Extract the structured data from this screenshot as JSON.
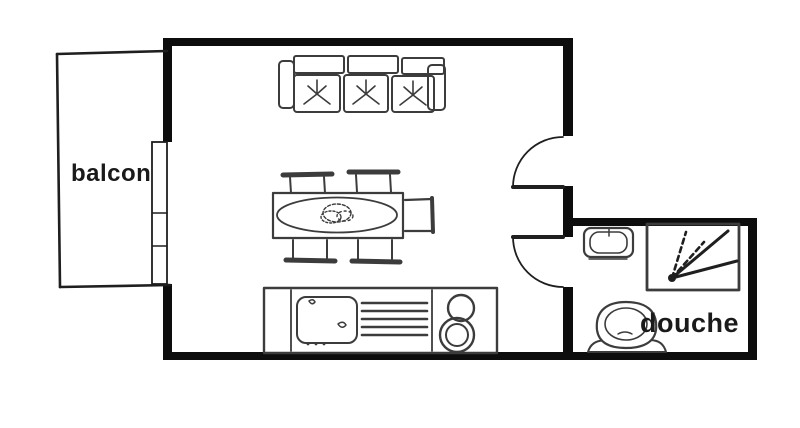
{
  "labels": {
    "balcony": "balcon",
    "shower": "douche"
  },
  "colors": {
    "background": "#ffffff",
    "wall": "#0d0d0d",
    "line": "#1f1f1f",
    "furniture": "#3c3c3c",
    "text": "#1a1a1a"
  },
  "fixtures": [
    "balcony-outline",
    "window",
    "sofa-three-seats",
    "dining-table-with-five-chairs",
    "kitchen-counter-with-sink-drainboard-and-two-burner-stove",
    "entrance-door-swing",
    "bathroom-door-swing",
    "washbasin",
    "shower-tray-with-spray",
    "toilet"
  ]
}
